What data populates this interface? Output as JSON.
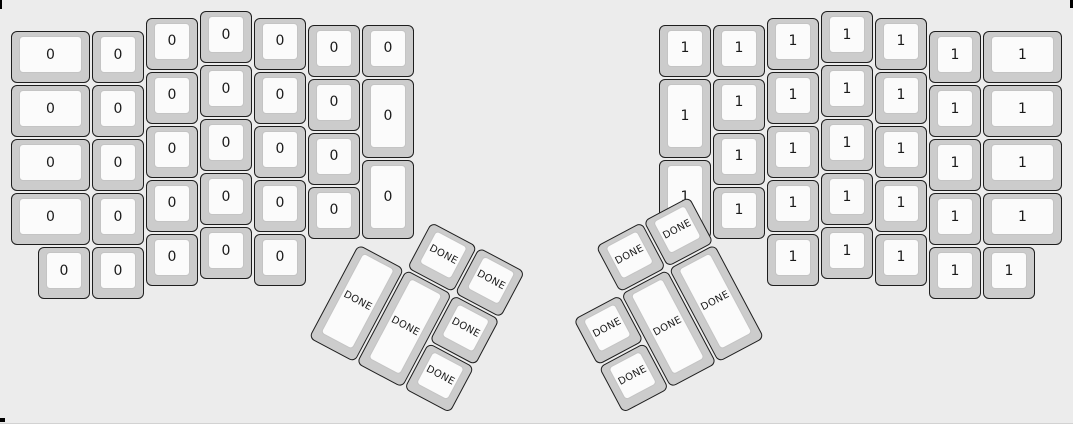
{
  "canvas": {
    "width": 1073,
    "height": 424,
    "background_color": "#ececec",
    "key_base_color": "#cccccc",
    "key_top_color": "#fbfbfb",
    "key_border_color": "#1e1e1e",
    "key_top_border_color": "#c4c4c4",
    "label_color": "#1a1a1a"
  },
  "keyboard": {
    "type": "split-ergo-keyboard-layout",
    "left_main": {
      "labels": [
        "0",
        "0",
        "0",
        "0",
        "0",
        "0",
        "0",
        "0",
        "0",
        "0",
        "0",
        "0",
        "0",
        "0",
        "0",
        "0",
        "0",
        "0",
        "0",
        "0",
        "0",
        "0",
        "0",
        "0",
        "0",
        "0",
        "0",
        "0",
        "0",
        "0",
        "0",
        "0"
      ]
    },
    "left_thumb": {
      "labels": [
        "DONE",
        "DONE",
        "DONE",
        "DONE",
        "DONE",
        "DONE"
      ]
    },
    "right_main": {
      "labels": [
        "1",
        "1",
        "1",
        "1",
        "1",
        "1",
        "1",
        "1",
        "1",
        "1",
        "1",
        "1",
        "1",
        "1",
        "1",
        "1",
        "1",
        "1",
        "1",
        "1",
        "1",
        "1",
        "1",
        "1",
        "1",
        "1",
        "1",
        "1",
        "1",
        "1",
        "1",
        "1"
      ]
    },
    "right_thumb": {
      "labels": [
        "DONE",
        "DONE",
        "DONE",
        "DONE",
        "DONE",
        "DONE"
      ]
    }
  }
}
